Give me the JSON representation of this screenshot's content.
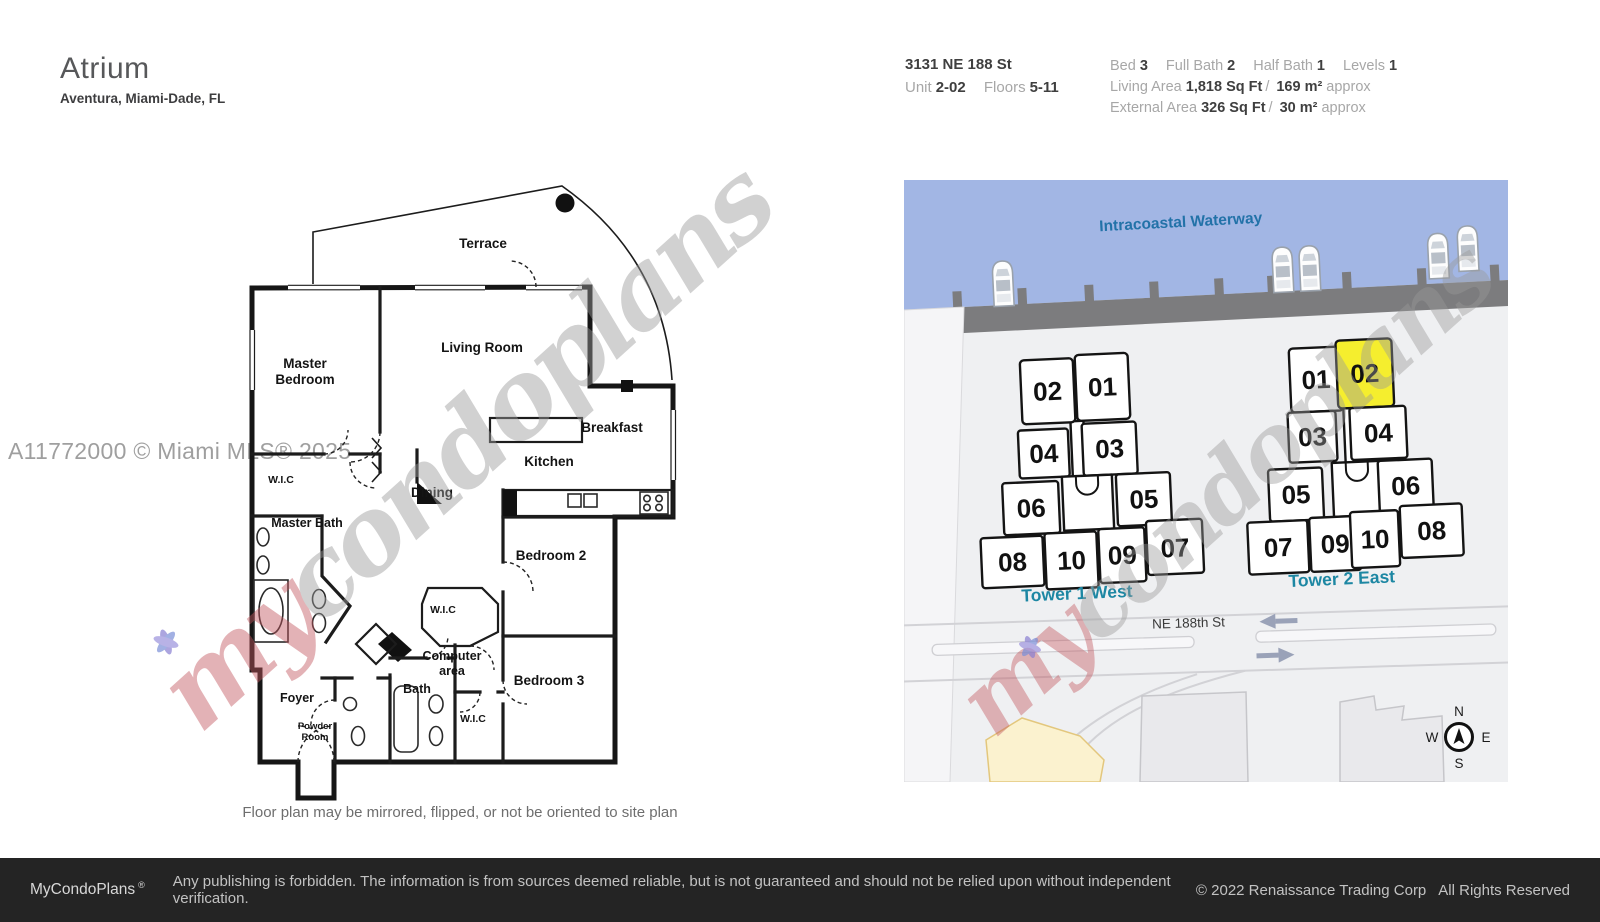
{
  "header": {
    "title": "Atrium",
    "subtitle": "Aventura, Miami-Dade, FL",
    "address": "3131 NE 188 St",
    "unit_label": "Unit",
    "unit_value": "2-02",
    "floors_label": "Floors",
    "floors_value": "5-11",
    "specs": [
      {
        "label": "Bed",
        "value": "3"
      },
      {
        "label": "Full Bath",
        "value": "2"
      },
      {
        "label": "Half Bath",
        "value": "1"
      },
      {
        "label": "Levels",
        "value": "1"
      }
    ],
    "living_area": {
      "label": "Living Area",
      "imperial": "1,818 Sq Ft",
      "sep": "/",
      "metric": "169 m²",
      "approx": "approx"
    },
    "external_area": {
      "label": "External Area",
      "imperial": "326 Sq Ft",
      "sep": "/",
      "metric": "30 m²",
      "approx": "approx"
    }
  },
  "floorplan": {
    "labels": {
      "terrace": "Terrace",
      "master_1": "Master",
      "master_2": "Bedroom",
      "living": "Living Room",
      "breakfast": "Breakfast",
      "kitchen": "Kitchen",
      "dining": "Dining",
      "wic_master": "W.I.C",
      "master_bath": "Master Bath",
      "bedroom2": "Bedroom 2",
      "wic_mid": "W.I.C",
      "computer_1": "Computer",
      "computer_2": "area",
      "bedroom3": "Bedroom 3",
      "bath": "Bath",
      "foyer": "Foyer",
      "powder_1": "Powder",
      "powder_2": "Room",
      "wic_b3": "W.I.C"
    },
    "note": "Floor plan may be mirrored, flipped, or not be oriented to site plan"
  },
  "siteplan": {
    "waterway": "Intracoastal Waterway",
    "street": "NE 188th St",
    "tower1": {
      "label": "Tower 1 West",
      "units": [
        "02",
        "01",
        "04",
        "03",
        "06",
        "05",
        "08",
        "10",
        "09",
        "07"
      ]
    },
    "tower2": {
      "label": "Tower 2 East",
      "units": [
        "01",
        "02",
        "03",
        "04",
        "05",
        "06",
        "07",
        "09",
        "10",
        "08"
      ],
      "highlighted_unit": "02"
    },
    "compass": {
      "n": "N",
      "e": "E",
      "s": "S",
      "w": "W"
    }
  },
  "watermarks": {
    "mls": "A11772000 © Miami MLS® 2025",
    "script_red": "my",
    "script_gray": "condoplans"
  },
  "footer": {
    "brand": "MyCondoPlans",
    "reg": "®",
    "disclaimer": "Any publishing is forbidden. The information is from sources deemed reliable, but is not guaranteed and should not be relied upon without independent verification.",
    "copyright": "© 2022 Renaissance Trading Corp",
    "rights": "All Rights Reserved"
  },
  "colors": {
    "water": "#a2b6e4",
    "dock": "#7c7c7e",
    "unit_fill": "#ffffff",
    "unit_highlight": "#f5ee2e",
    "tower_label": "#1d87a3",
    "waterway_label": "#2272a8",
    "footer_bg": "#242424",
    "watermark_red": "#c2565e",
    "watermark_gray": "#9a9a9a",
    "yellow_area": "#fbf2cf"
  }
}
